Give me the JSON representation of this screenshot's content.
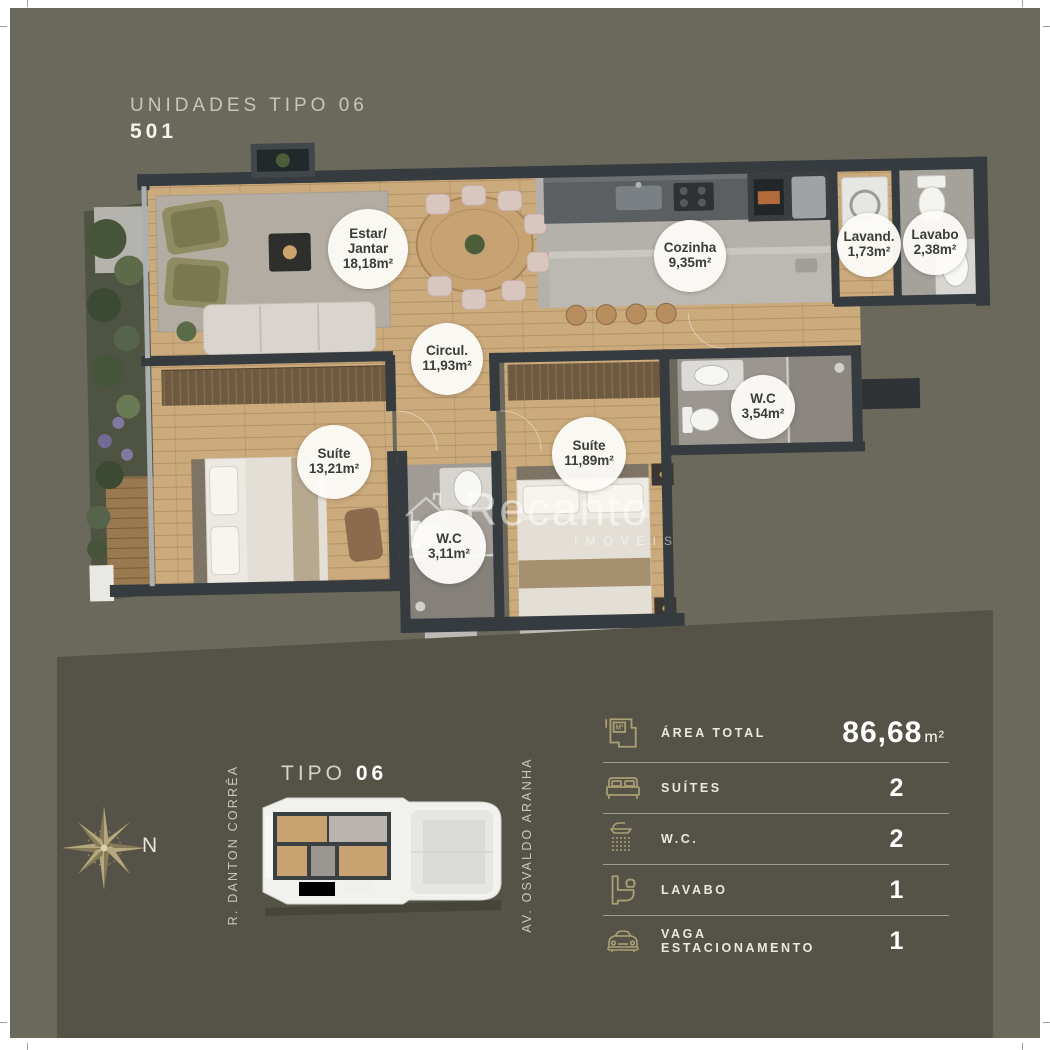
{
  "header": {
    "title": "UNIDADES TIPO 06",
    "unit": "501"
  },
  "floorplan": {
    "watermark": {
      "brand": "Recanto",
      "sub": "IMÓVEIS"
    },
    "rooms": [
      {
        "name": "Estar/\nJantar",
        "area": "18,18m²"
      },
      {
        "name": "Cozinha",
        "area": "9,35m²"
      },
      {
        "name": "Lavand.",
        "area": "1,73m²"
      },
      {
        "name": "Lavabo",
        "area": "2,38m²"
      },
      {
        "name": "Circul.",
        "area": "11,93m²"
      },
      {
        "name": "W.C",
        "area": "3,54m²"
      },
      {
        "name": "Suíte",
        "area": "13,21m²"
      },
      {
        "name": "Suíte",
        "area": "11,89m²"
      },
      {
        "name": "W.C",
        "area": "3,11m²"
      }
    ]
  },
  "location": {
    "north_label": "N",
    "plan_type_prefix": "TIPO",
    "plan_type_number": "06",
    "street_left": "R. DANTON CORRÊA",
    "street_right": "AV. OSVALDO ARANHA"
  },
  "specs": {
    "rows": [
      {
        "icon": "area-total-icon",
        "label": "ÁREA TOTAL",
        "value": "86,68",
        "unit": "m²"
      },
      {
        "icon": "bed-icon",
        "label": "SUÍTES",
        "value": "2",
        "unit": ""
      },
      {
        "icon": "shower-icon",
        "label": "W.C.",
        "value": "2",
        "unit": ""
      },
      {
        "icon": "sink-icon",
        "label": "LAVABO",
        "value": "1",
        "unit": ""
      },
      {
        "icon": "car-icon",
        "label": "VAGA ESTACIONAMENTO",
        "value": "1",
        "unit": ""
      }
    ]
  },
  "colors": {
    "background": "#6b695b",
    "bottom_panel": "#555348",
    "accent_gold": "#ab9f74",
    "wall": "#353b3f",
    "wood_floor": "#cbaa7c",
    "badge_bg": "#fcfbf7",
    "badge_text": "#3b3b38",
    "white": "#ffffff"
  }
}
